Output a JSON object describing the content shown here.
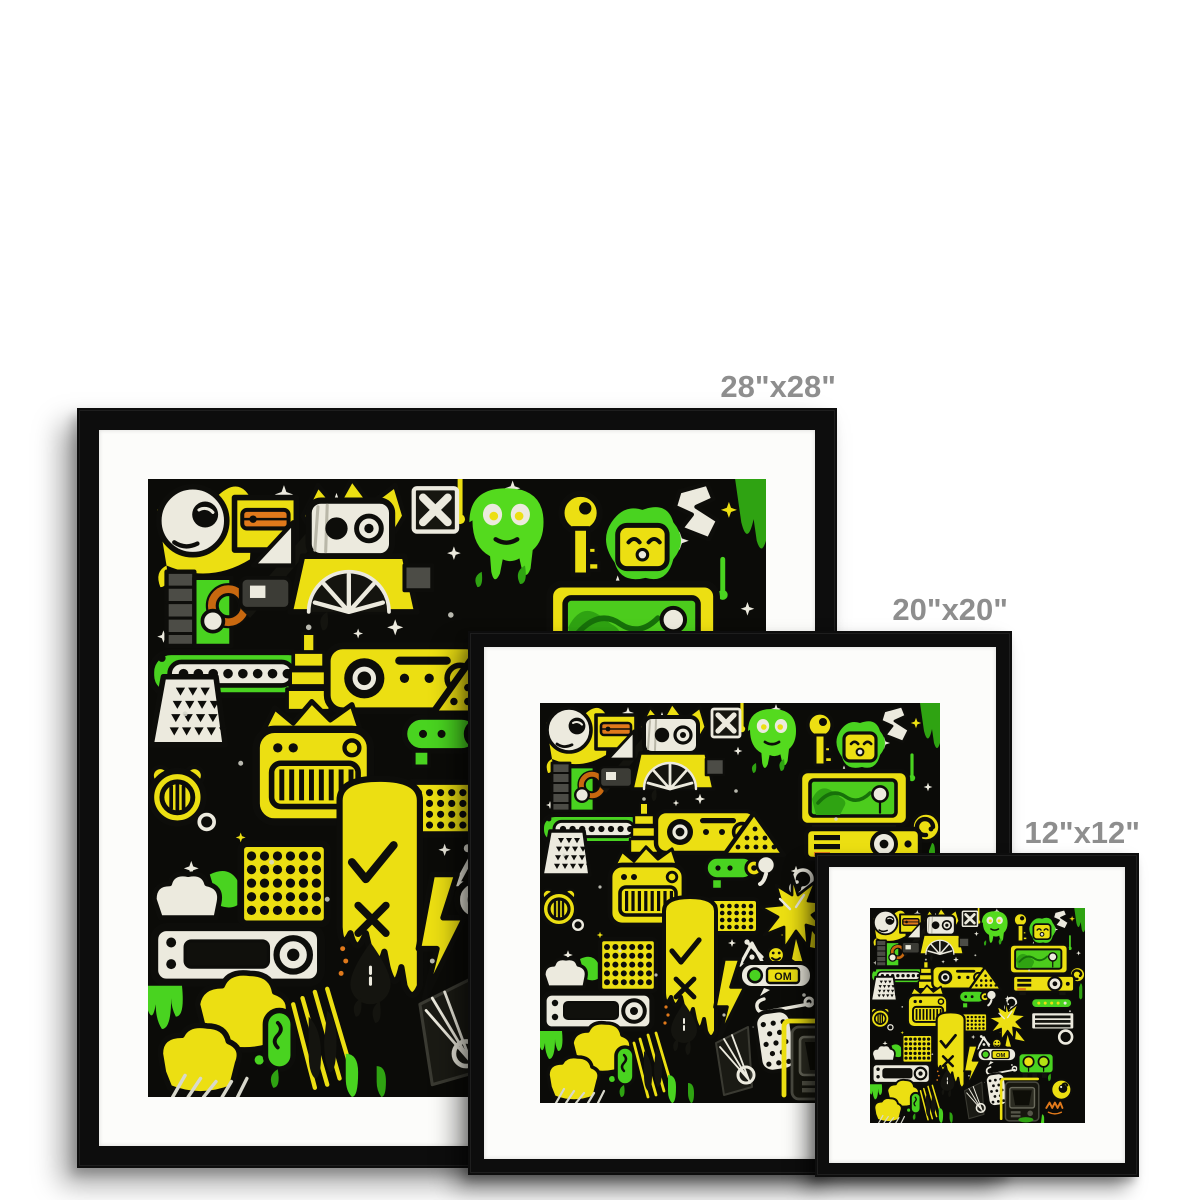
{
  "page": {
    "type": "product-mockup",
    "subject": "Graffiti doodle art print shown framed in three sizes"
  },
  "sizes": [
    {
      "id": "28",
      "label": "28\"x28\"",
      "width_in": 28,
      "height_in": 28
    },
    {
      "id": "20",
      "label": "20\"x20\"",
      "width_in": 20,
      "height_in": 20
    },
    {
      "id": "12",
      "label": "12\"x12\"",
      "width_in": 12,
      "height_in": 12
    }
  ],
  "artwork": {
    "title": "Green and yellow graffiti doodle collage on black",
    "radio_text": "OM",
    "motifs": [
      "white-moon-face",
      "robot-head",
      "green-alien-ghost",
      "yellow-key",
      "tv-screen",
      "speaker-grilles",
      "piano-radio",
      "car-stereo",
      "yellow-clouds",
      "lightning-bolt",
      "black-teardrop",
      "orange-spray-tag",
      "sparkles",
      "paint-drips"
    ]
  },
  "colors": {
    "page_bg": "#ffffff",
    "label_gray": "#8e8e8e",
    "frame_black": "#0d0d0d",
    "mat_white": "#fcfcfa",
    "art_bg": "#0b0b08",
    "art_yellow": "#ecdf12",
    "art_green": "#49d320",
    "art_green_dark": "#2fa312",
    "art_white": "#eceade",
    "art_gray": "#4c4c46",
    "art_orange": "#e0791b"
  }
}
